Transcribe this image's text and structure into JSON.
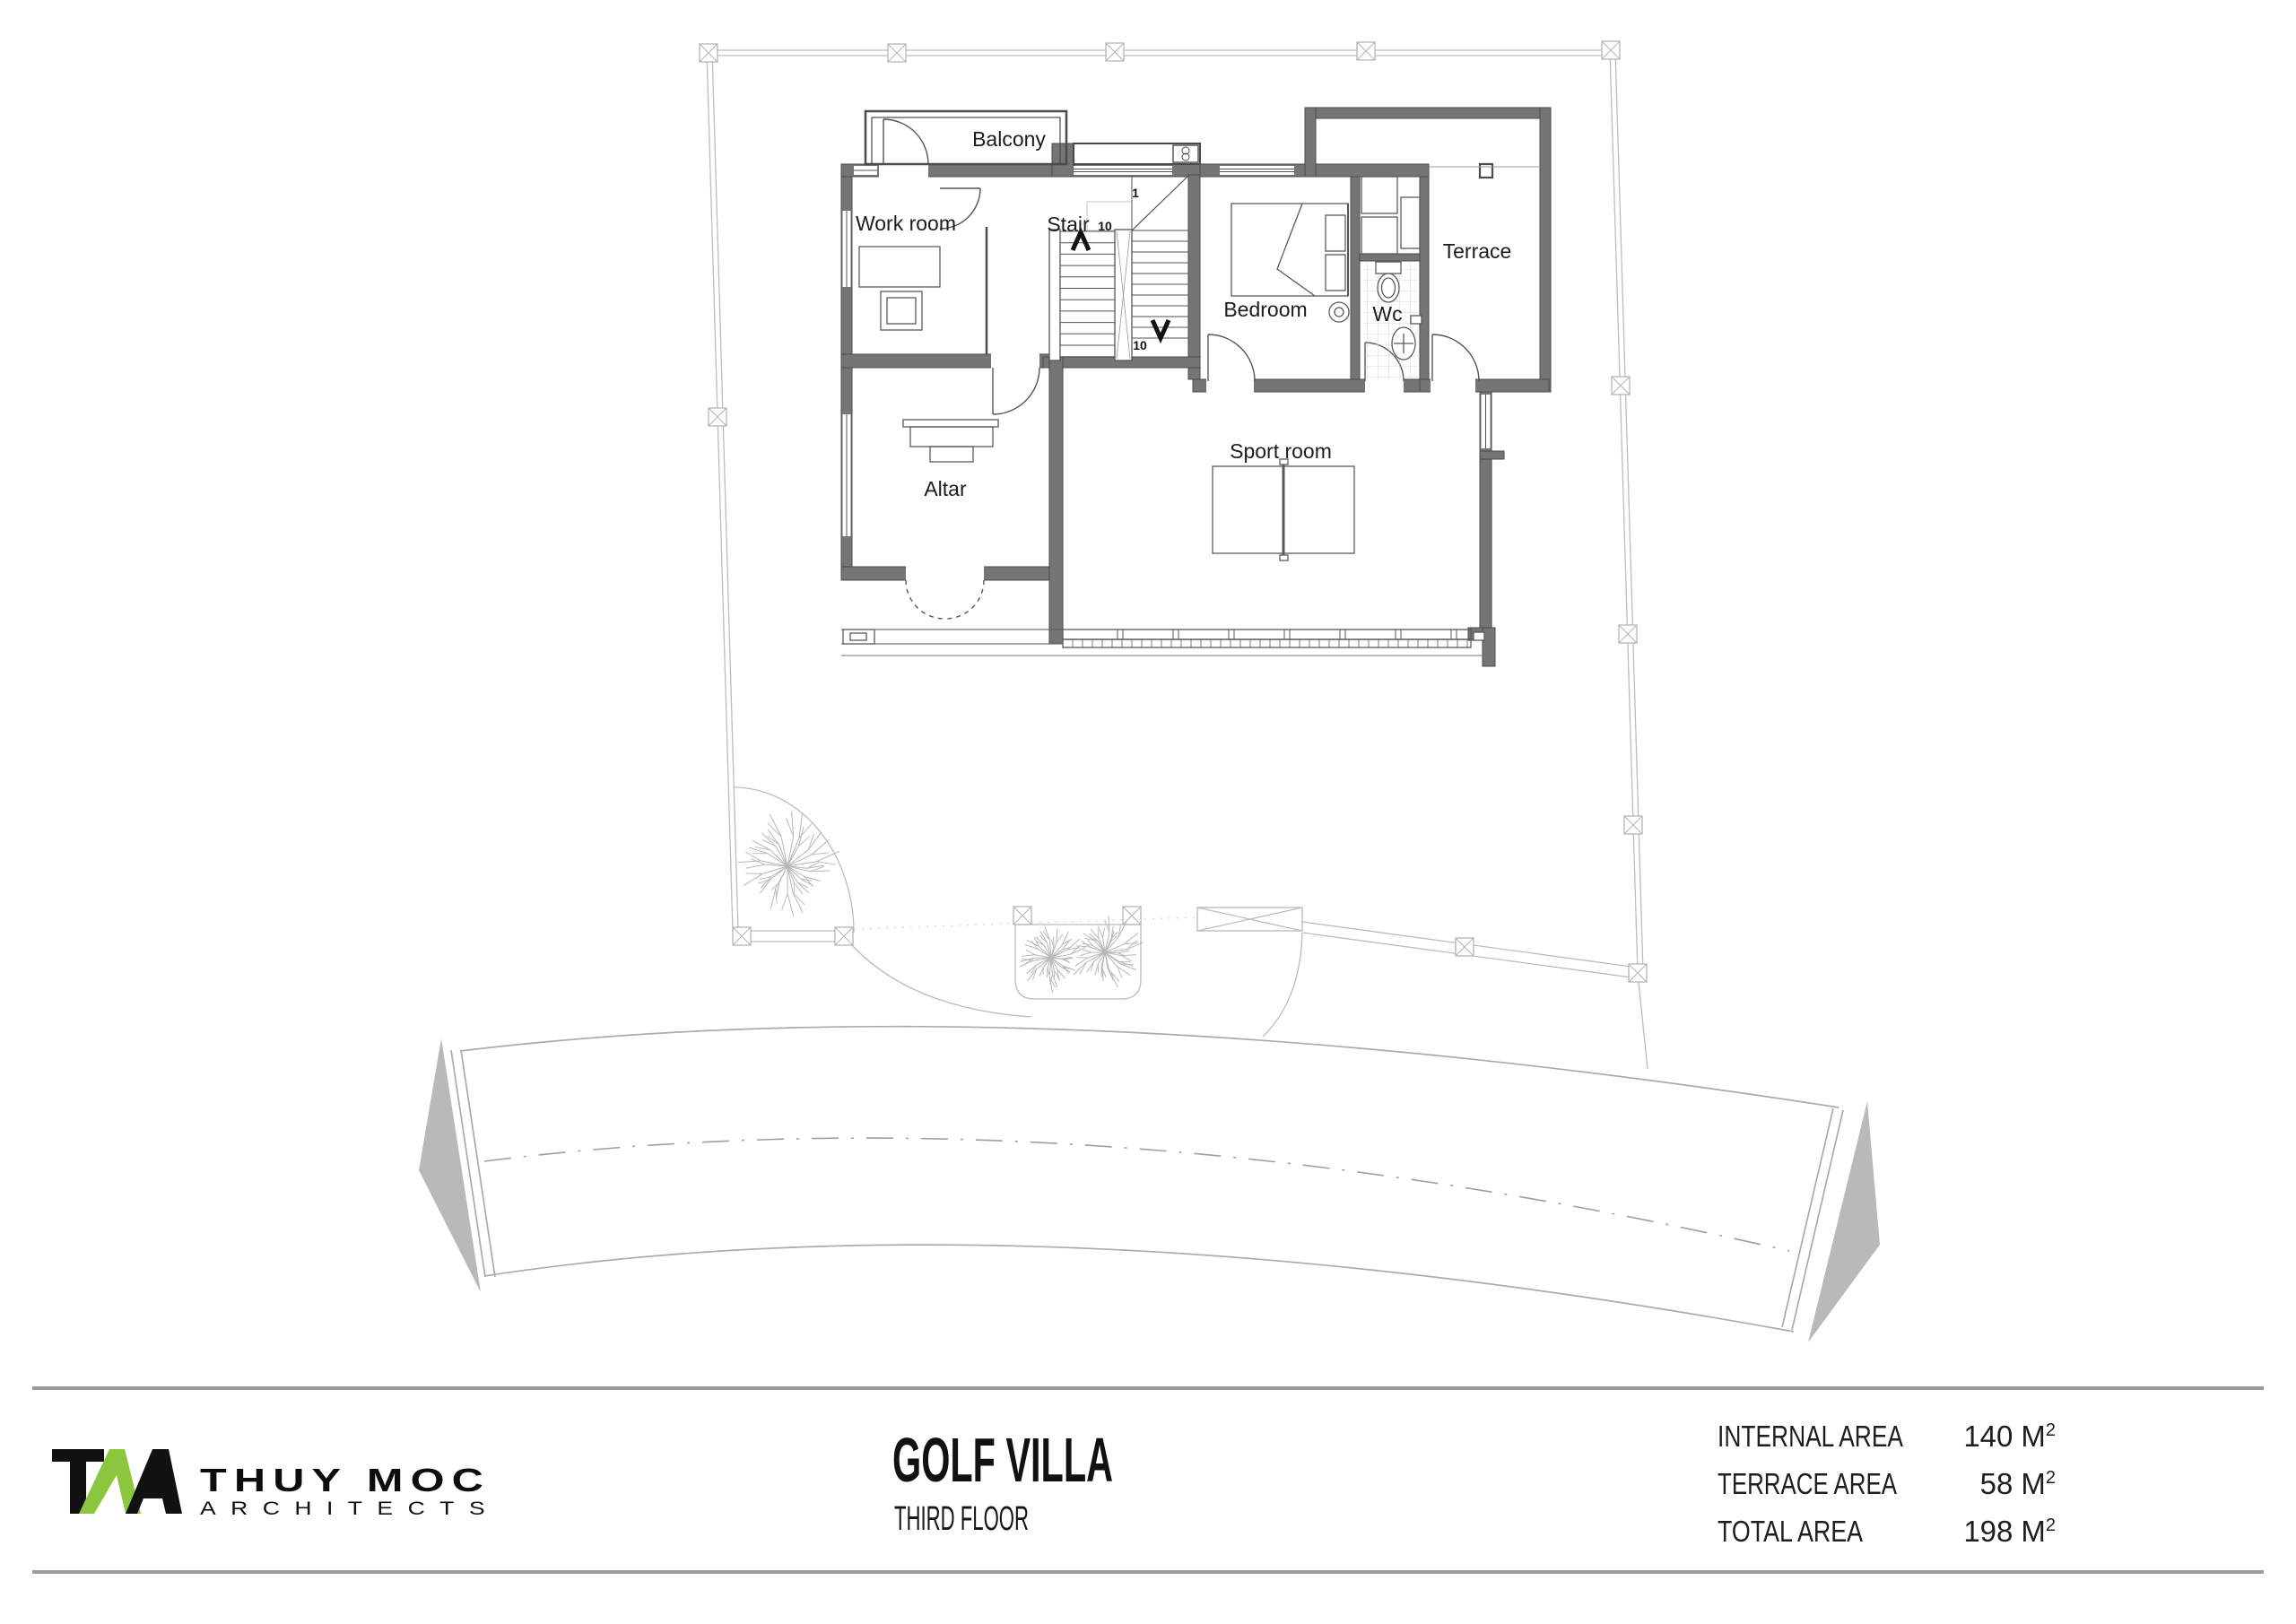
{
  "sheet": {
    "title": "GOLF VILLA",
    "floor": "THIRD FLOOR"
  },
  "logo": {
    "company": "THUY MOC",
    "tagline": "ARCHITECTS",
    "monogram_icon": "tma-monogram",
    "accent_color": "#8cc63e"
  },
  "area_table": {
    "rows": [
      {
        "label": "INTERNAL AREA",
        "value": "140",
        "unit": "M",
        "sup": "2"
      },
      {
        "label": "TERRACE AREA",
        "value": "58",
        "unit": "M",
        "sup": "2"
      },
      {
        "label": "TOTAL AREA",
        "value": "198",
        "unit": "M",
        "sup": "2"
      }
    ]
  },
  "plan": {
    "rooms": [
      {
        "label": "Balcony"
      },
      {
        "label": "Work room"
      },
      {
        "label": "Stair"
      },
      {
        "label": "Bedroom"
      },
      {
        "label": "Wc"
      },
      {
        "label": "Terrace"
      },
      {
        "label": "Altar"
      },
      {
        "label": "Sport room"
      }
    ],
    "stair_marks": {
      "top": "1",
      "mid": "10",
      "bottom": "10"
    }
  },
  "colors": {
    "wall": "#757575",
    "line": "#4b4b4b",
    "site_line": "#bdbdbd",
    "road_line": "#ababab",
    "end_cap_gray": "#b9b9b9",
    "accent_green": "#8cc63e"
  }
}
